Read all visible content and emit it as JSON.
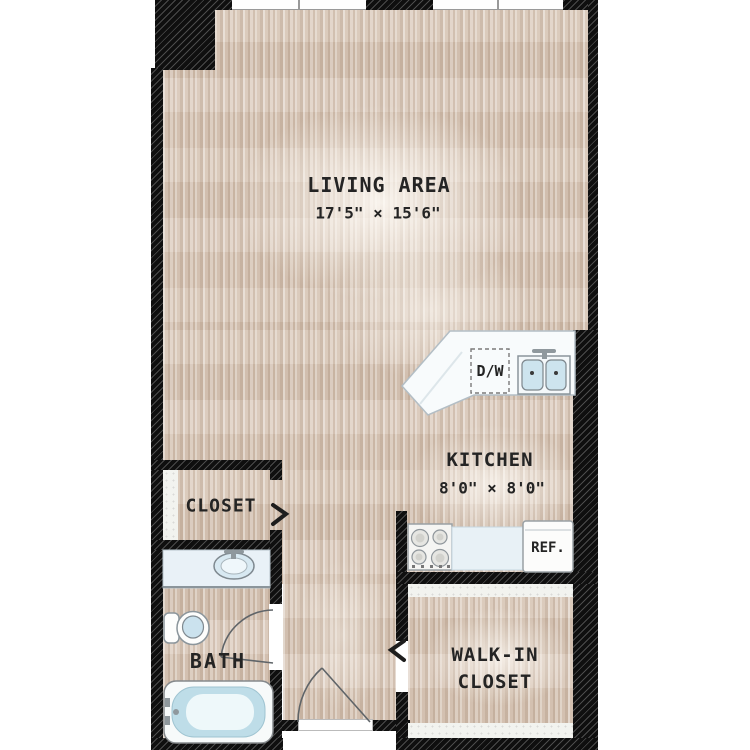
{
  "floorplan": {
    "rooms": {
      "living": {
        "label": "LIVING AREA",
        "dims": "17'5\" × 15'6\""
      },
      "kitchen": {
        "label": "KITCHEN",
        "dims": "8'0\" × 8'0\""
      },
      "closet": {
        "label": "CLOSET"
      },
      "bath": {
        "label": "BATH"
      },
      "walkin": {
        "lines": [
          "WALK-IN",
          "CLOSET"
        ]
      }
    },
    "appliances": {
      "dishwasher": "D/W",
      "refrigerator": "REF."
    },
    "icons": {
      "closet_door": "chevron-right",
      "walkin_door": "chevron-left",
      "bath_door": "quarter-arc-swing",
      "entry_door": "quarter-arc-swing",
      "fixtures": [
        "bathtub",
        "toilet",
        "vanity-sink",
        "kitchen-double-sink",
        "stove",
        "refrigerator",
        "dishwasher",
        "windows"
      ]
    },
    "colors": {
      "wall": "#111111",
      "floor": "#d7c5b5",
      "floor_light": "#eadfd1",
      "water": "#bedde8",
      "counter": "#f8fbfc",
      "line": "#5f6468"
    }
  }
}
